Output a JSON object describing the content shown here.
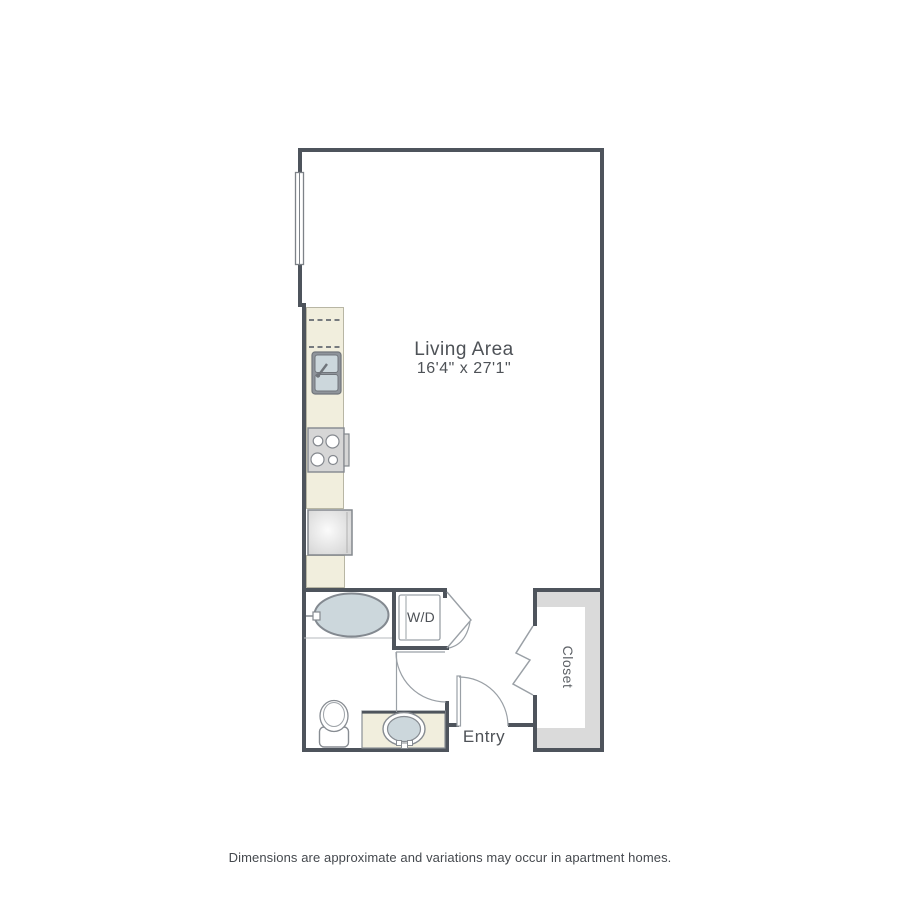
{
  "floorplan": {
    "living_area": {
      "label": "Living Area",
      "dimensions": "16'4\" x 27'1\""
    },
    "labels": {
      "washer_dryer": "W/D",
      "entry": "Entry",
      "closet": "Closet"
    },
    "footer": "Dimensions are approximate and variations may occur in apartment homes.",
    "colors": {
      "wall": "#4e545c",
      "counter": "#f1eedd",
      "counter_border": "#b8b6a4",
      "appliance": "#d6d6d6",
      "appliance_border": "#84888e",
      "fixture": "#ccd7dc",
      "fixture_border": "#838990",
      "shelf": "#dadada",
      "line": "#9aa0a6",
      "text": "#4e5257"
    }
  }
}
